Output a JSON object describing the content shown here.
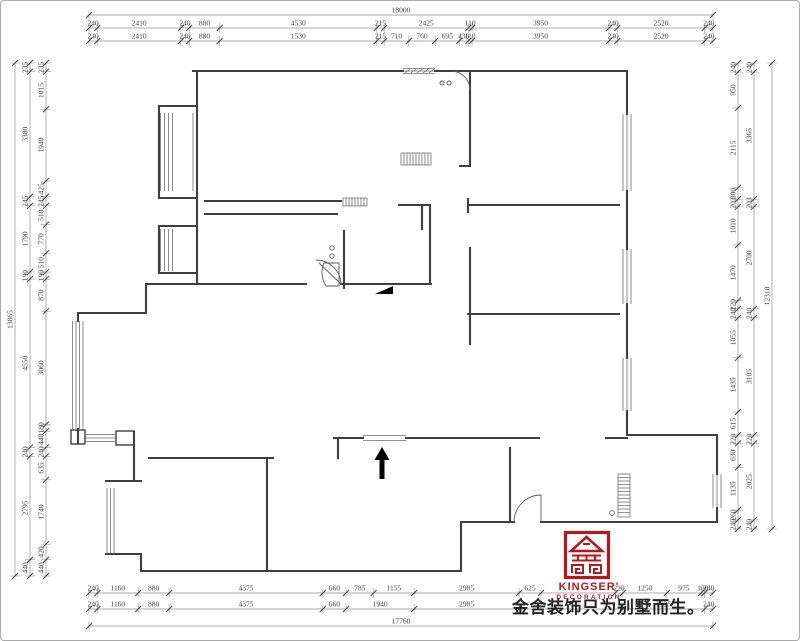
{
  "dimensions": {
    "top": {
      "total": "18000",
      "outer": [
        "240",
        "2410",
        "240",
        "880",
        "4530",
        "215",
        "2425",
        "110",
        "3950",
        "240",
        "2520",
        "240"
      ],
      "inner": [
        "240",
        "2410",
        "240",
        "880",
        {
          "t": "1530",
          "w": 4530
        },
        "215",
        "710",
        "760",
        "695",
        {
          "t": "430",
          "w": 260
        },
        "110",
        "3950",
        "240",
        "2520",
        "240"
      ]
    },
    "bottom": {
      "total": "17760",
      "outer": [
        "240",
        "1160",
        "880",
        "4375",
        "660",
        "785",
        "1155",
        "2985",
        "625",
        {
          "t": "",
          "w": 2110
        },
        "220",
        "1250",
        "975",
        "100",
        "240"
      ],
      "inner": [
        "240",
        "1160",
        "880",
        "4375",
        "660",
        "1940",
        "2985",
        {
          "t": "",
          "w": 2955
        },
        "2325",
        "240"
      ]
    },
    "left": {
      "total": "13865",
      "outer": [
        "235",
        "3380",
        "245",
        "1790",
        "190",
        "4550",
        "240",
        "2795",
        "440"
      ],
      "inner": [
        "235",
        "1015",
        "1940",
        "425",
        "245",
        "510",
        "770",
        "510",
        "190",
        "870",
        "3060",
        "180",
        "440",
        "240",
        "635",
        "1740",
        "420",
        "440"
      ]
    },
    "right": {
      "total": "12310",
      "outer": [
        "240",
        "3365",
        "203",
        "2700",
        "240",
        "3105",
        "220",
        "2025",
        "240"
      ],
      "inner": [
        "240",
        "950",
        "2115",
        "300",
        "203",
        "1010",
        "1470",
        "220",
        "240",
        "1055",
        "1435",
        "615",
        "220",
        "630",
        "1135",
        "260",
        "240"
      ]
    }
  },
  "branding": {
    "brand": "KINGSER'",
    "sub": "DECORATION",
    "slogan": "金舍装饰只为别墅而生。",
    "logo_color": "#b5191e"
  },
  "colors": {
    "wall": "#3f3f3f",
    "dim_line": "#8f8f8f",
    "dim_text": "#3f3f3f",
    "logo_red": "#b5191e"
  }
}
